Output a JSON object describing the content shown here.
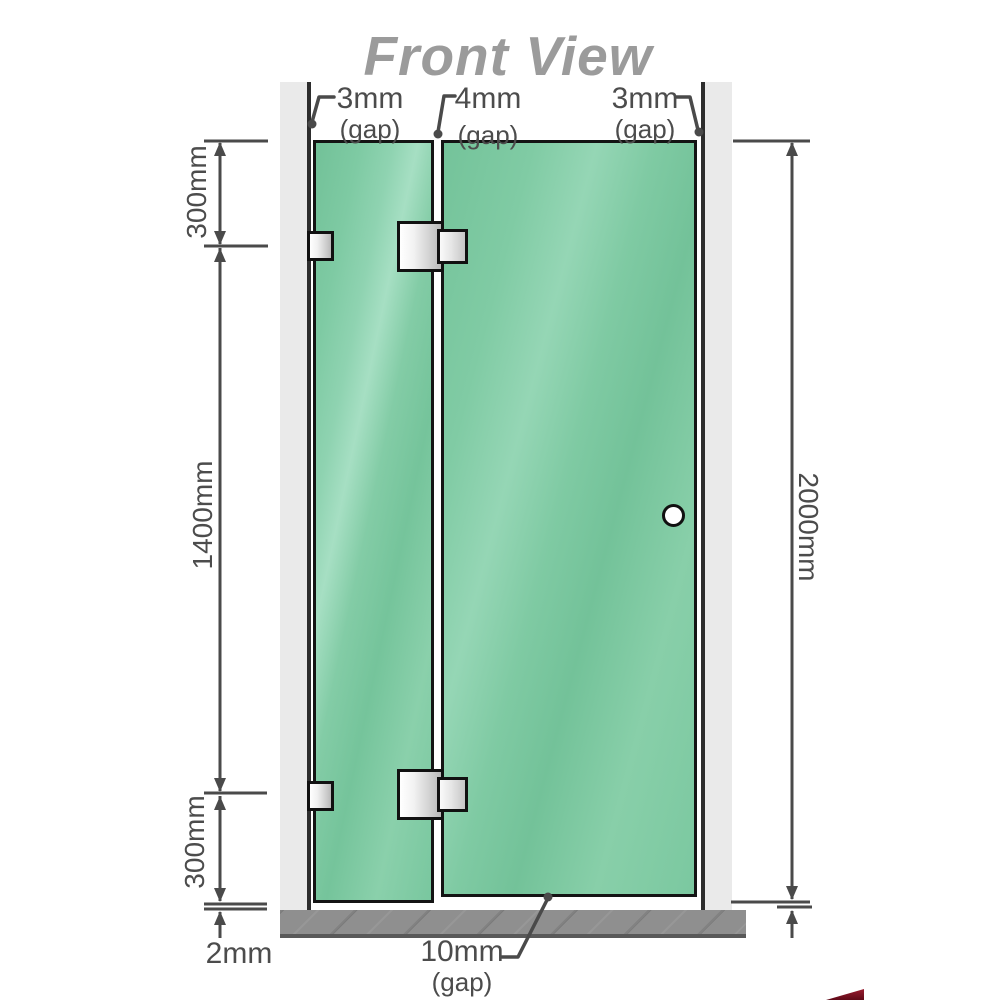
{
  "title": "Front View",
  "gaps_top": {
    "left": {
      "value": "3mm",
      "caption": "(gap)"
    },
    "middle": {
      "value": "4mm",
      "caption": "(gap)"
    },
    "right": {
      "value": "3mm",
      "caption": "(gap)"
    }
  },
  "dims_left": {
    "top": "300mm",
    "middle": "1400mm",
    "bottom": "300mm",
    "floor_gap": "2mm"
  },
  "dim_right": {
    "total_height": "2000mm"
  },
  "gap_bottom": {
    "value": "10mm",
    "caption": "(gap)"
  },
  "colors": {
    "glass_green": "#7cc8a1",
    "hardware_silver": "#d9d9d9",
    "wall_channel_gray": "#eaeaea",
    "channel_edge_dark": "#2d2d2d",
    "floor_gray": "#8f8f8f",
    "dimension_gray": "#4a4a4a",
    "title_gray": "#9b9b9b",
    "watermark_red": "#7e1020"
  }
}
